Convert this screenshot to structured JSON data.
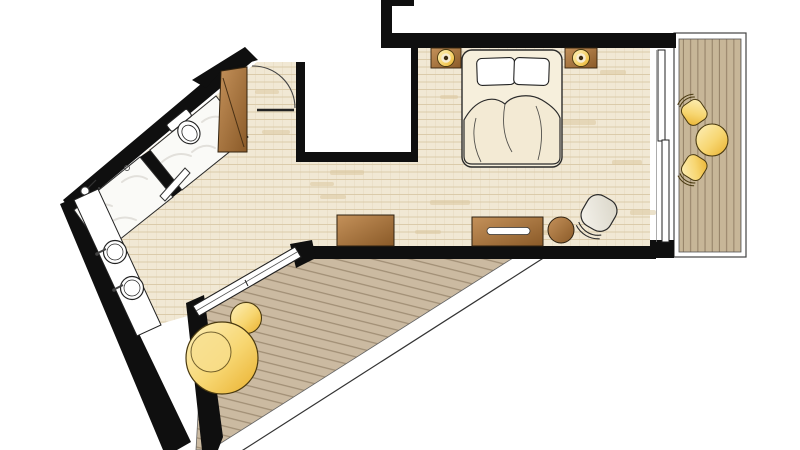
{
  "plan": {
    "type": "hotel-room-floor-plan",
    "rooms": [
      "bedroom",
      "entrance-hall",
      "wc-room",
      "shower-room",
      "vanity-area",
      "courtyard-lightwell",
      "balcony",
      "terrace-deck"
    ],
    "furniture": [
      "double-bed",
      "pillow-left",
      "pillow-right",
      "nightstand-left",
      "nightstand-right",
      "table-lamp-left",
      "table-lamp-right",
      "dresser",
      "writing-desk",
      "round-stool",
      "armchair",
      "wardrobe",
      "toilet",
      "shower-head",
      "shower-glass-door",
      "vanity-counter",
      "sink-upper",
      "sink-lower",
      "round-daybed",
      "side-pouf",
      "balcony-table",
      "balcony-chair-top",
      "balcony-chair-bottom"
    ],
    "doors": [
      "entrance-swing-door",
      "terrace-sliding-door",
      "balcony-sliding-door"
    ]
  },
  "colors": {
    "background": "#ffffff",
    "wall": "#0f0f0f",
    "outline": "#444444",
    "railing": "#333333",
    "ink": "#2b2b2b",
    "floor_base": "#f1e8d4",
    "floor_line": "#d9c8a6",
    "floor_streak": "#dcc9a0",
    "deck_base": "#cbbaa1",
    "deck_line": "#96846a",
    "balcony_base": "#c7b698",
    "balcony_line": "#8e7c62",
    "marble": "#fafaf7",
    "marble_vein": "#e0ded8",
    "linen": "#f6efdc",
    "white": "#ffffff",
    "gold_light": "#fdf0bb",
    "gold_mid": "#f7d671",
    "gold_deep": "#e9b02e",
    "gold_stroke": "#4a3a10",
    "brown_light": "#c4915a",
    "brown_deep": "#8a5a28",
    "brown_stroke": "#33230f",
    "chair_light": "#f6f4ee",
    "chair_deep": "#d8d4c6",
    "lamp_ring": "#f6ecd2",
    "lamp_center": "#3c2c10"
  }
}
